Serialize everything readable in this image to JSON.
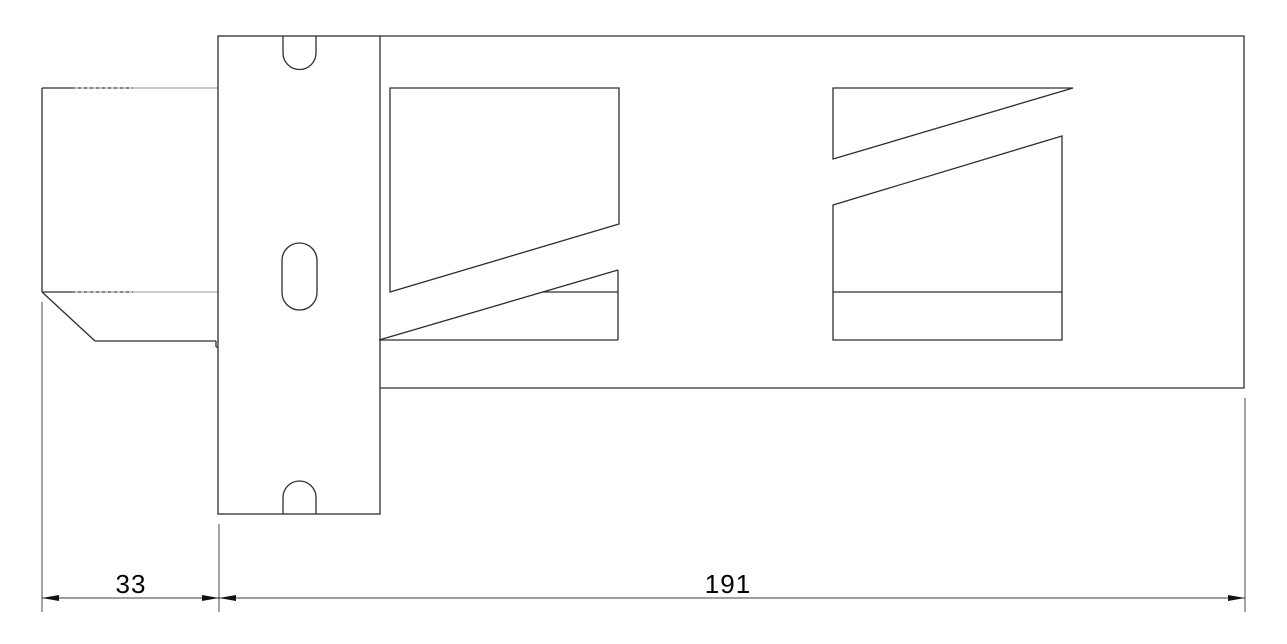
{
  "drawing": {
    "background_color": "#ffffff",
    "line_color": "#2e2e2e",
    "dimension_color": "#000000",
    "dimensions": {
      "left_width": {
        "value": "33"
      },
      "beam_length": {
        "value": "191"
      }
    }
  }
}
